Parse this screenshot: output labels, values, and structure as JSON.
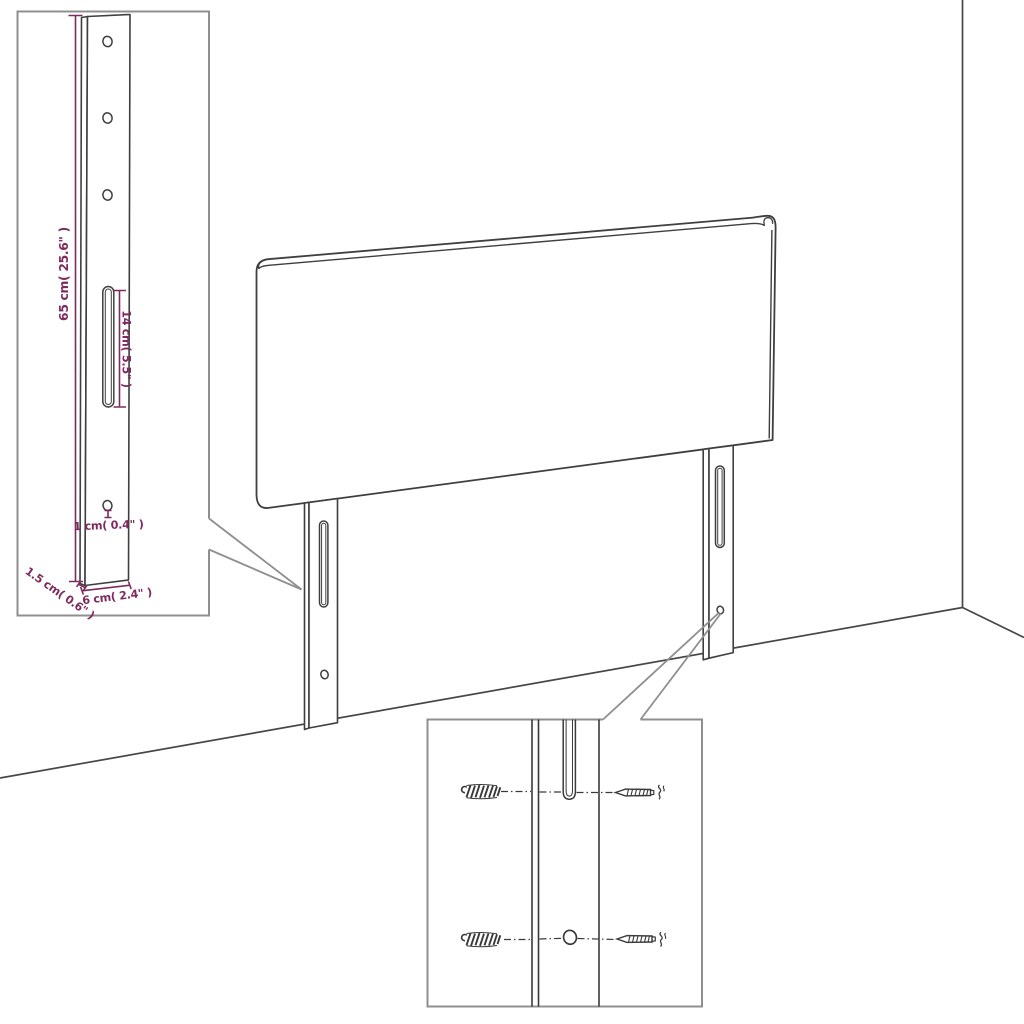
{
  "diagram": {
    "colors": {
      "line_art": "#3f3f3f",
      "callout": "#8f8f8f",
      "dimension": "#7d2b5e",
      "background": "#ffffff"
    },
    "leg_detail": {
      "dimensions": {
        "leg_height": "65 cm( 25.6\" )",
        "slot_length": "14 cm( 5.5\" )",
        "hole_size": "1 cm( 0.4\" )",
        "leg_thickness": "1.5 cm( 0.6\" )",
        "leg_width": "6 cm( 2.4\" )"
      }
    },
    "hardware_detail": {
      "wall_plug_count": 2,
      "screw_count": 2
    }
  }
}
